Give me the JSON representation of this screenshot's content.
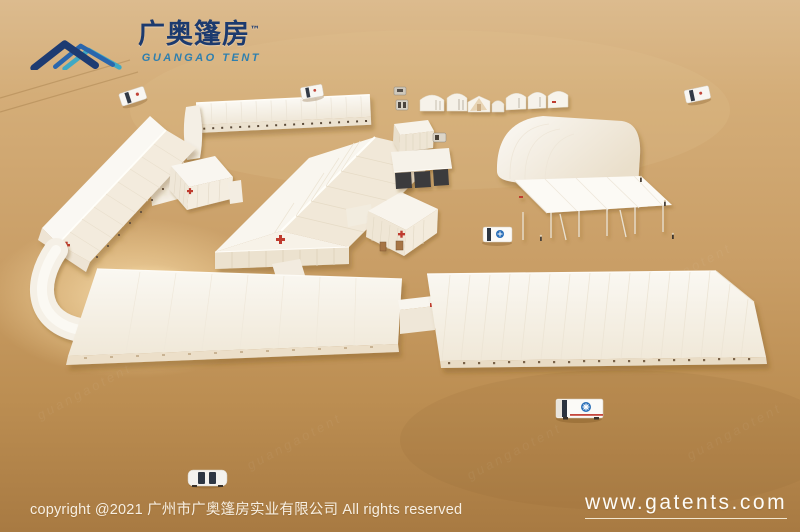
{
  "branding": {
    "logo_cn": "广奥篷房",
    "logo_tm": "™",
    "logo_en": "GUANGAO TENT"
  },
  "footer": {
    "copyright": "copyright @2021 广州市广奥篷房实业有限公司 All rights reserved",
    "website": "www.gatents.com"
  },
  "scene": {
    "description": "Aerial 3D render of a white field-hospital tent camp on desert sand: long warehouse tents linked by corridors, red-cross medical tents, an arched hangar tent, an open scaffold canopy, a row of small tents, ambulances and a car",
    "watermark": "guangaotent"
  },
  "colors": {
    "sand": "#c99f67",
    "tent_white": "#f8f5ee",
    "cross_red": "#bf3b2f",
    "logo_navy": "#1d3b72",
    "logo_blue": "#2a66ad",
    "logo_teal": "#3fa9c4",
    "star_of_life_blue": "#2a6fb8"
  }
}
